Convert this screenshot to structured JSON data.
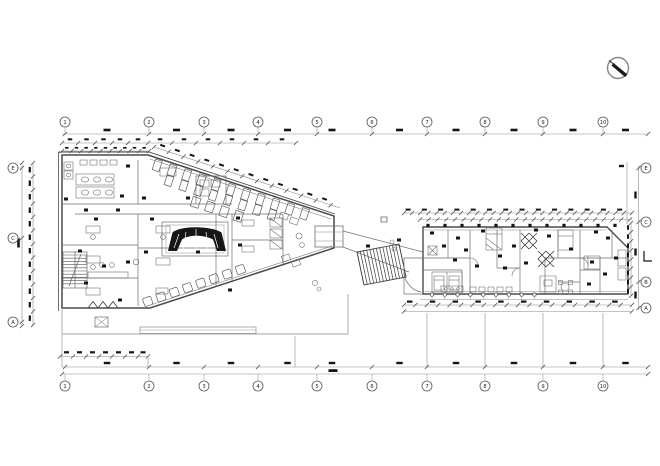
{
  "drawing": {
    "kind": "architectural-floor-plan"
  },
  "grid_labels": {
    "top": [
      "1",
      "2",
      "3",
      "4",
      "5",
      "6",
      "7",
      "8",
      "9",
      "10"
    ],
    "bottom": [
      "1",
      "2",
      "3",
      "4",
      "5",
      "6",
      "7",
      "8",
      "9",
      "10"
    ],
    "left": [
      "E",
      "C",
      "A"
    ],
    "right": [
      "E",
      "C",
      "B",
      "A"
    ]
  },
  "icons": {
    "north_arrow": "north-arrow"
  },
  "colors": {
    "wall": "#4a4a4c",
    "thin": "#6f6f72",
    "light": "#8a8a8d",
    "dark": "#161616",
    "bubble_stroke": "#55555a",
    "bubble_text": "#1f1f1f"
  }
}
